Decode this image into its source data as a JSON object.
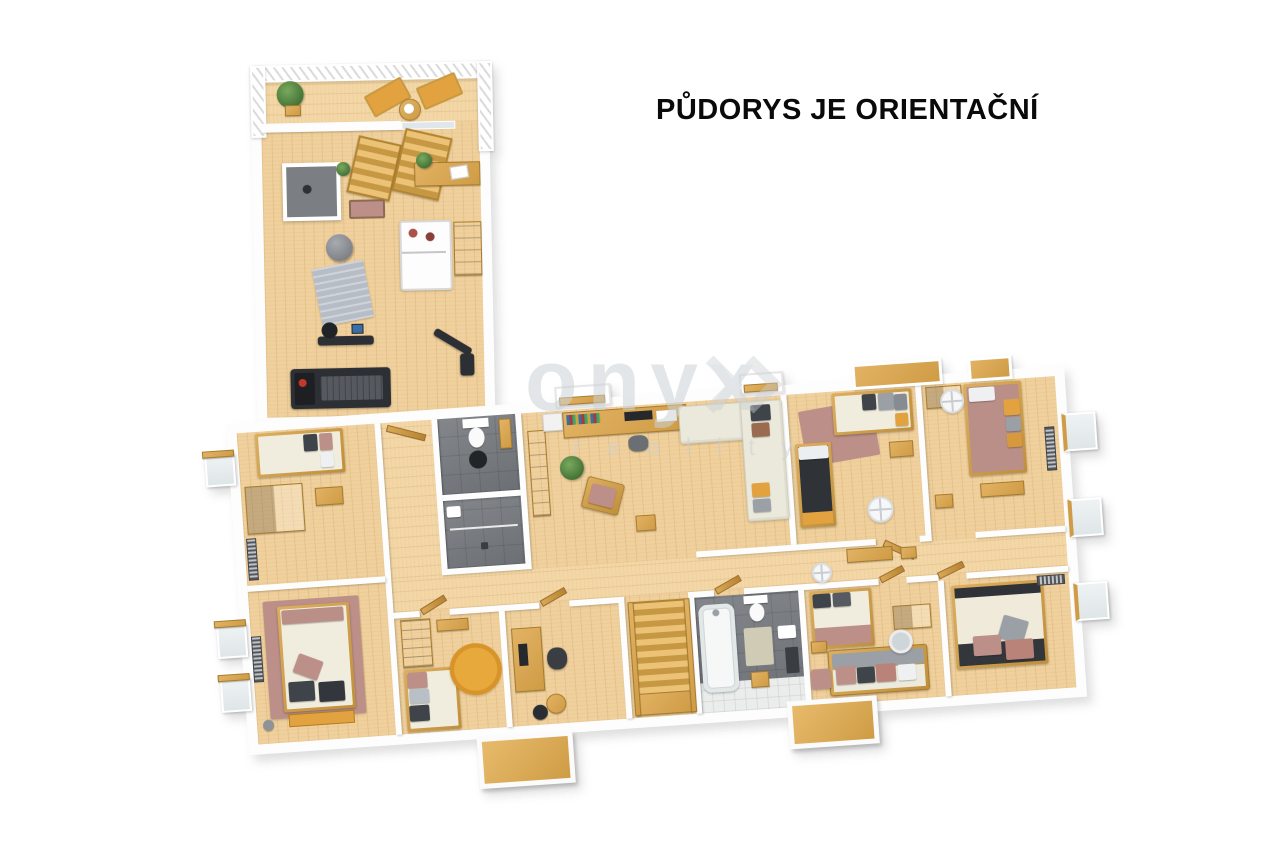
{
  "title": "PŮDORYS JE ORIENTAČNÍ",
  "watermark": {
    "brand": "onyx",
    "subtitle": "reality"
  },
  "colors": {
    "background": "#ffffff",
    "title_text": "#0a0a0a",
    "wood_floor": "#f0d09c",
    "wood_furniture": "#cf9c45",
    "wall": "#fdfdfd",
    "tile_dark": "#75797e",
    "tile_light": "#eaedec",
    "mauve": "#bc8f88",
    "dark_pillow": "#3f434a",
    "gray_pillow": "#9aa0a6",
    "orange_accent": "#e2a23f",
    "sofa_cream": "#ebe9dc",
    "plant_green": "#3f6e33",
    "equipment_dark": "#2c2f34",
    "rug_orange": "#e8a93c",
    "watermark_gray": "#cdd1d5"
  }
}
